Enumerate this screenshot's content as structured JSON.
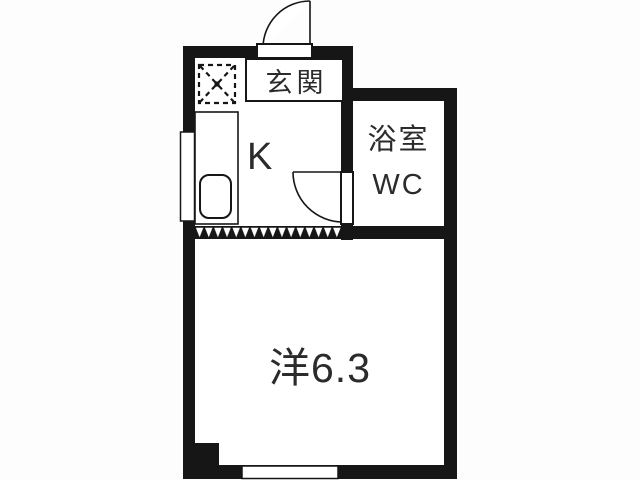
{
  "title": "apartment-floor-plan",
  "colors": {
    "wall": "#161616",
    "floor": "#ffffff",
    "line": "#1a1a1a",
    "text": "#2b2b2b",
    "background": "#fdfdfd"
  },
  "labels": {
    "entrance": "玄関",
    "kitchen": "K",
    "bathroom_line1": "浴室",
    "bathroom_line2": "WC",
    "main_room": "洋6.3"
  },
  "fixtures": [
    "washing-machine-space",
    "kitchen-counter",
    "kitchen-sink",
    "entrance-door-swing",
    "bathroom-door-swing",
    "accordion-partition",
    "left-window",
    "bottom-window",
    "corner-pillar"
  ]
}
